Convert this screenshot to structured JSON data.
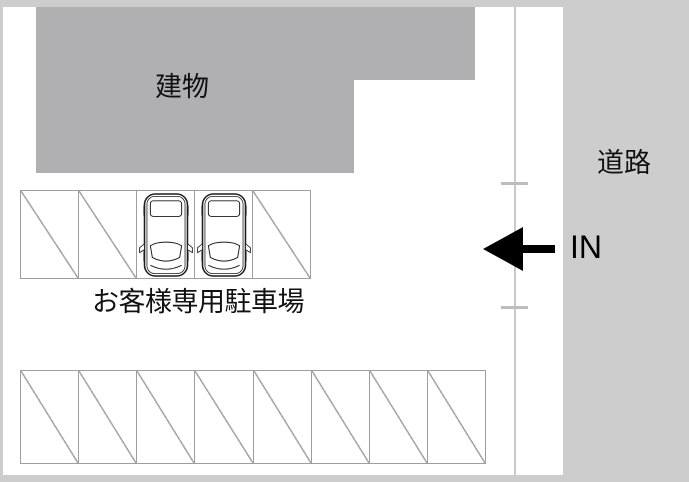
{
  "diagram": {
    "title": "parking-access-map",
    "building": {
      "label": "建物"
    },
    "road": {
      "label": "道路"
    },
    "entrance": {
      "label": "IN",
      "arrow_direction": "left"
    },
    "customer_parking": {
      "label": "お客様専用駐車場",
      "stalls": [
        "empty",
        "empty",
        "car",
        "car",
        "empty"
      ]
    },
    "public_parking": {
      "stalls": [
        "empty",
        "empty",
        "empty",
        "empty",
        "empty",
        "empty",
        "empty",
        "empty"
      ]
    },
    "colors": {
      "frame": "#cdcdcd",
      "road": "#cdcdcd",
      "building": "#b0b0b2",
      "stall_border": "#9e9e9e",
      "diagonal": "#a9a9a9",
      "boundary_line": "#c9c9c9",
      "tick": "#bdbdbd",
      "arrow": "#000000",
      "text": "#111111"
    }
  }
}
